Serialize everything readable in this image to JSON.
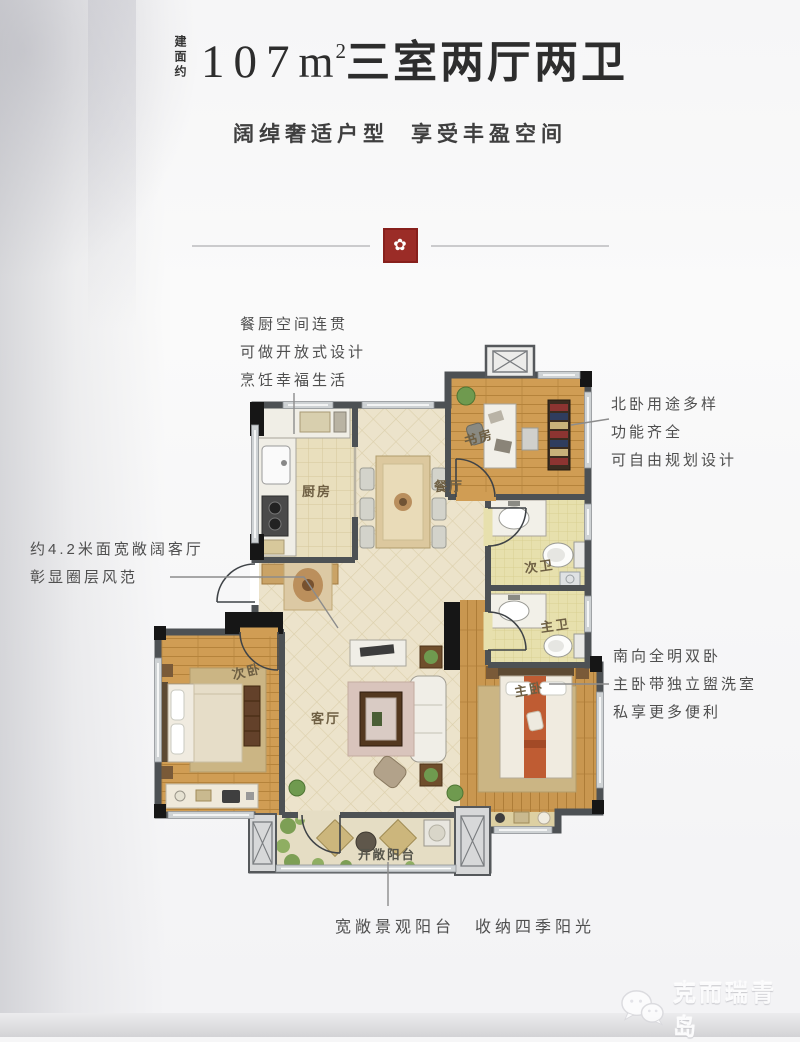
{
  "palette": {
    "page_bg": "#f7f7f8",
    "seal_red": "#9b2c27",
    "wall_gray": "#4d5154",
    "column_black": "#161616",
    "wood_floor": "#d09d54",
    "cream_tile": "#ece3cb",
    "kitchen_tile": "#e9dfbd",
    "bath_tile": "#e7e0ad",
    "bed_runner_orange": "#bf5c33",
    "title_text": "#2d2d2d",
    "note_text": "#4f4f4f"
  },
  "header": {
    "area_prefix": "建面约",
    "area_value": "107",
    "area_unit": "m",
    "area_exp": "2",
    "title_suffix": "三室两厅两卫",
    "subtitle_left": "阔绰奢适户型",
    "subtitle_right": "享受丰盈空间"
  },
  "divider": {
    "seal_glyph": "✿"
  },
  "notes": {
    "kitchen": {
      "lines": [
        "餐厨空间连贯",
        "可做开放式设计",
        "烹饪幸福生活"
      ]
    },
    "north_room": {
      "lines": [
        "北卧用途多样",
        "功能齐全",
        "可自由规划设计"
      ]
    },
    "living": {
      "lines": [
        "约4.2米面宽敞阔客厅",
        "彰显圈层风范"
      ]
    },
    "south_rooms": {
      "lines": [
        "南向全明双卧",
        "主卧带独立盥洗室",
        "私享更多便利"
      ]
    },
    "balcony": {
      "text": "宽敞景观阳台　收纳四季阳光"
    }
  },
  "rooms": {
    "kitchen": "厨房",
    "dining": "餐厅",
    "study": "书房",
    "bath_second": "次卫",
    "bath_master": "主卫",
    "bed_second": "次卧",
    "living": "客厅",
    "bed_master": "主卧",
    "balcony": "开敞阳台"
  },
  "watermark": {
    "text": "克而瑞青岛"
  }
}
